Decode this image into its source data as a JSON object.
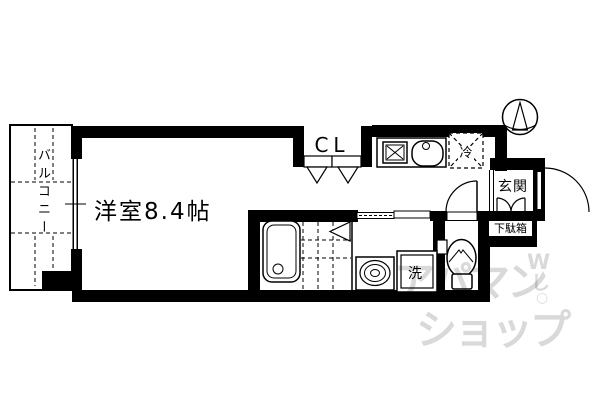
{
  "title": "apartment-floor-plan",
  "labels": {
    "room": "洋室8.4帖",
    "balcony": "バルコニー",
    "closet": "CL",
    "refrigerator": "冷",
    "entrance": "玄関",
    "shoe_cabinet": "下駄箱",
    "washing_machine": "洗"
  },
  "watermark": {
    "line1": "アパマン",
    "line2": "ショップ",
    "mark1": "W",
    "mark2": "し",
    "mark3": "○"
  },
  "colors": {
    "line": "#000000",
    "background": "#ffffff",
    "watermark_text": "rgba(0,0,0,0.15)"
  }
}
